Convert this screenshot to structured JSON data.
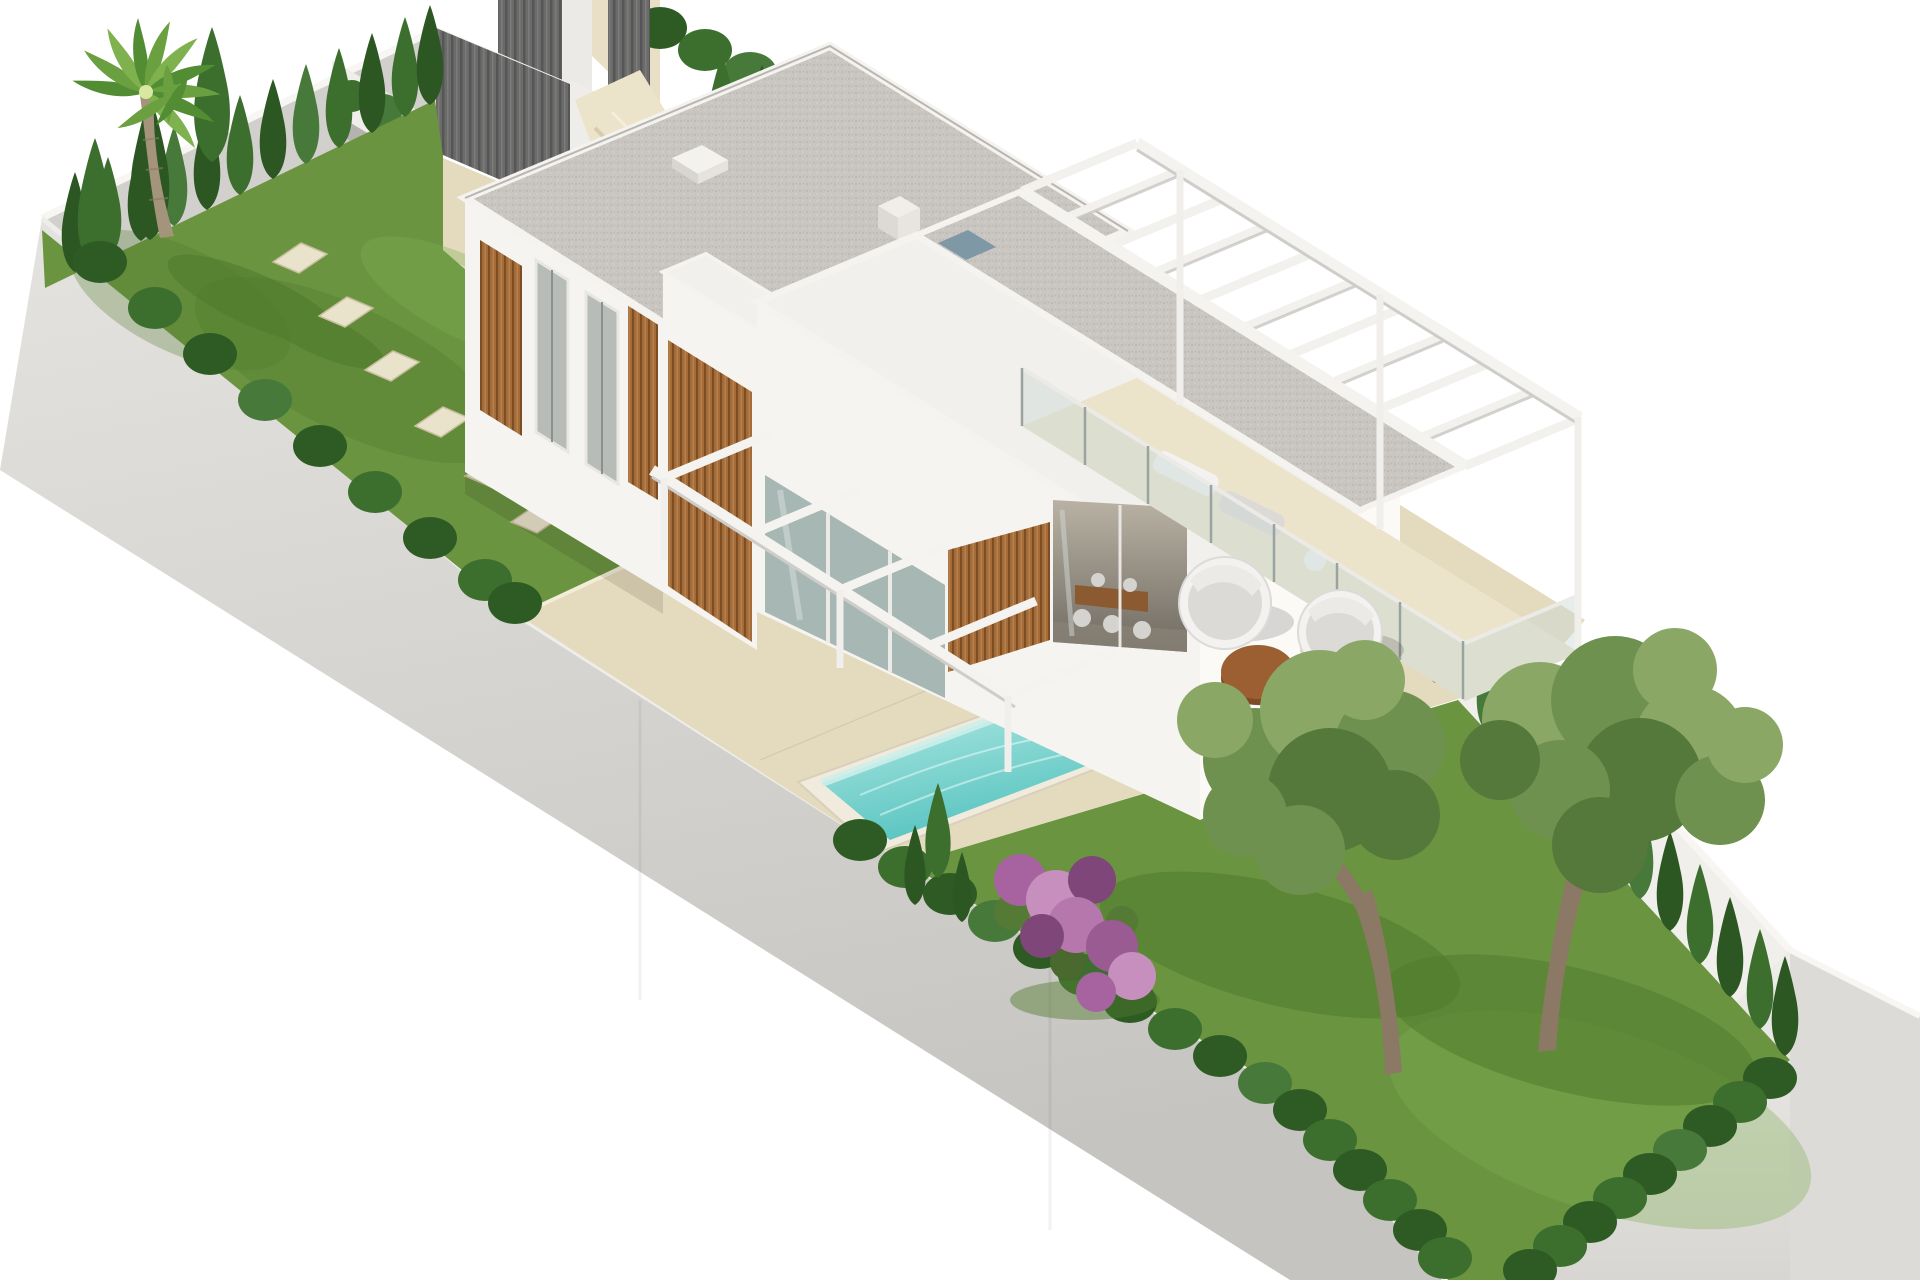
{
  "meta": {
    "title": "Isometric aerial render of a modern villa plot",
    "type": "architectural-3d-render",
    "view": "isometric aerial",
    "canvas": {
      "width": 1920,
      "height": 1280
    }
  },
  "palette": {
    "bg": "#ffffff",
    "wallInnerLight": "#e8e6e2",
    "wallInnerShade": "#d2d0cc",
    "wallBright": "#f1efeb",
    "wallOuterTop": "#e3e1dd",
    "wallOuterBottom": "#c7c5c1",
    "wallCap": "#f7f6f2",
    "fenceDark": "#6b6b69",
    "fenceSlat": "#565658",
    "lawn": "#6b9440",
    "lawnLight": "#7fae52",
    "lawnDark": "#4e7a2c",
    "hedgeDark": "#2e5b24",
    "hedgeMid": "#3c6e2e",
    "hedgeLight": "#47793a",
    "cypressDark": "#2c5722",
    "beige": "#e4dabd",
    "beigeLight": "#ece3cb",
    "beigeDark": "#d3c7a6",
    "stone": "#eae3cb",
    "facadeSW": "#f6f4f0",
    "facadeSE": "#fbfaf7",
    "facadeShade": "#eceae5",
    "roofWhite": "#f2f0ec",
    "parapet": "#f5f3ef",
    "woodMid": "#a26b39",
    "woodDark": "#7d4e22",
    "woodLight": "#b87f49",
    "glass": "#9fb0ac",
    "glassLight": "#c9d8d5",
    "waterLight": "#a9e5e0",
    "waterDeep": "#58c4c0",
    "poolWall": "#cdeeea",
    "coping": "#f0ebdc",
    "purpleMain": "#a763a0",
    "purpleLight": "#c78fbe",
    "purpleDark": "#7f4779",
    "oliveLight": "#8aa766",
    "oliveMid": "#6f9150",
    "oliveDark": "#55793b",
    "trunk": "#8b7865",
    "palmTrunk": "#a4947c",
    "furnWhite": "#f3f2f0",
    "furnGray": "#dcdad6",
    "tableWood": "#9c5f31",
    "tableWoodDark": "#7e4b24"
  },
  "scene": {
    "background": "white studio cutout",
    "plot": {
      "label": "walled rectangular villa plot, isometric view",
      "walls": "white rendered perimeter walls"
    },
    "gate": {
      "label": "dark grey slatted entrance gate and fence on upper boundary"
    },
    "villa": {
      "label": "modern two-storey white villa",
      "storeys": 2,
      "roof": "flat gravel roofs with white parapets and skylight",
      "features": [
        "wood slat cladding",
        "floor-to-ceiling glazing",
        "upper terrace with glass balustrade",
        "white pergola beams over balcony",
        "ground-floor pergola over patio"
      ]
    },
    "pool": {
      "label": "rectangular turquoise swimming pool with pale coping"
    },
    "garden": {
      "label": "landscaped garden",
      "palm_trees": 1,
      "olive_trees": 2,
      "stepping_stones": 6,
      "flowering_shrub": "purple bougainvillea",
      "hedges": "cypress and box hedge rows along all perimeter walls",
      "lawns": 2,
      "planters": "lavender planter beside entrance steps"
    },
    "furniture": {
      "round_daybeds": 2,
      "coffee_table": 1,
      "sun_loungers_balcony": 2,
      "dining_set": "interior dining table with chairs visible through open glazing"
    }
  }
}
